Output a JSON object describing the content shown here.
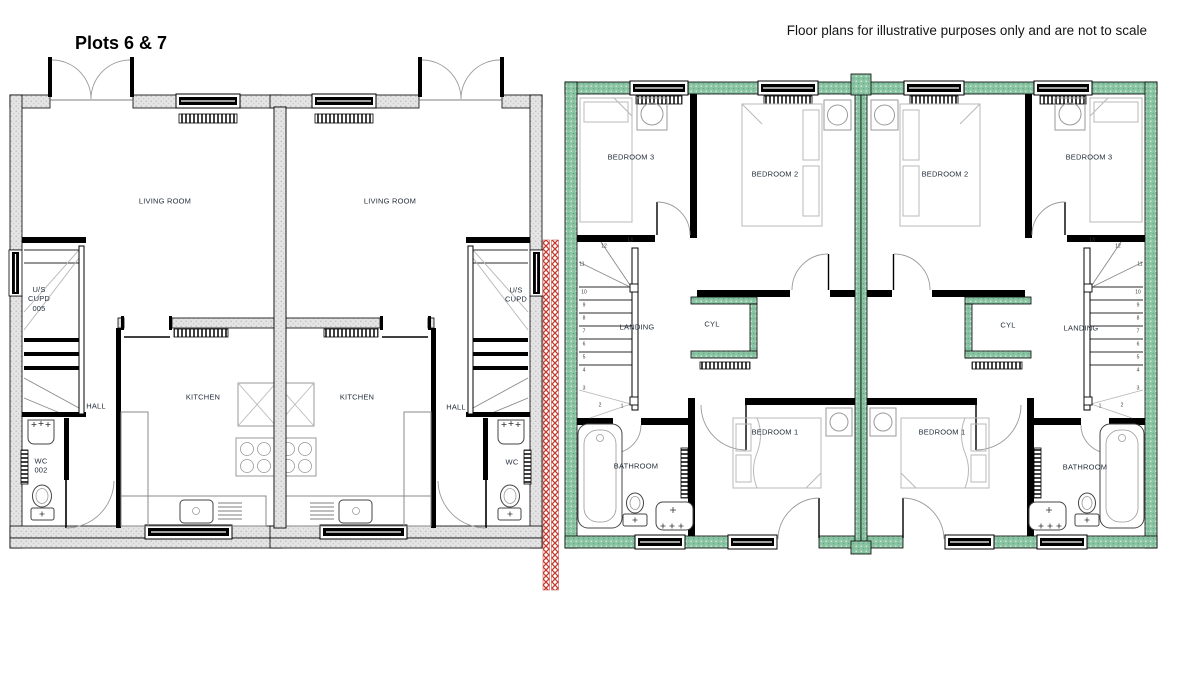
{
  "page": {
    "title": "Plots 6 & 7",
    "disclaimer": "Floor plans for illustrative purposes only and are not to scale"
  },
  "colors": {
    "ground_wall_fill": "#e4e4e4",
    "first_floor_wall_green": "#8ac4a3",
    "party_wall_hatch_red": "#c2392e",
    "wall_outline": "#000000",
    "label_text": "#1f2a36"
  },
  "ground_floor": {
    "name": "Ground floor plan",
    "labels": {
      "living_room_left": "LIVING ROOM",
      "living_room_right": "LIVING ROOM",
      "cupboard_left": "U/S\nCUPD\n005",
      "cupboard_right": "U/S\nCUPD",
      "kitchen_left": "KITCHEN",
      "kitchen_right": "KITCHEN",
      "hall_left": "HALL",
      "hall_right": "HALL",
      "wc_left": "WC\n002",
      "wc_right": "WC"
    }
  },
  "first_floor": {
    "name": "First floor plan",
    "labels": {
      "bedroom3_left": "BEDROOM 3",
      "bedroom2_left": "BEDROOM 2",
      "bedroom2_right": "BEDROOM 2",
      "bedroom3_right": "BEDROOM 3",
      "landing_left": "LANDING",
      "cyl_left": "CYL",
      "cyl_right": "CYL",
      "landing_right": "LANDING",
      "bedroom1_left": "BEDROOM 1",
      "bedroom1_right": "BEDROOM 1",
      "bathroom_left": "BATHROOM",
      "bathroom_right": "BATHROOM"
    },
    "stair_steps": [
      "1",
      "2",
      "3",
      "4",
      "5",
      "6",
      "7",
      "8",
      "9",
      "10",
      "11",
      "12",
      "13"
    ]
  }
}
